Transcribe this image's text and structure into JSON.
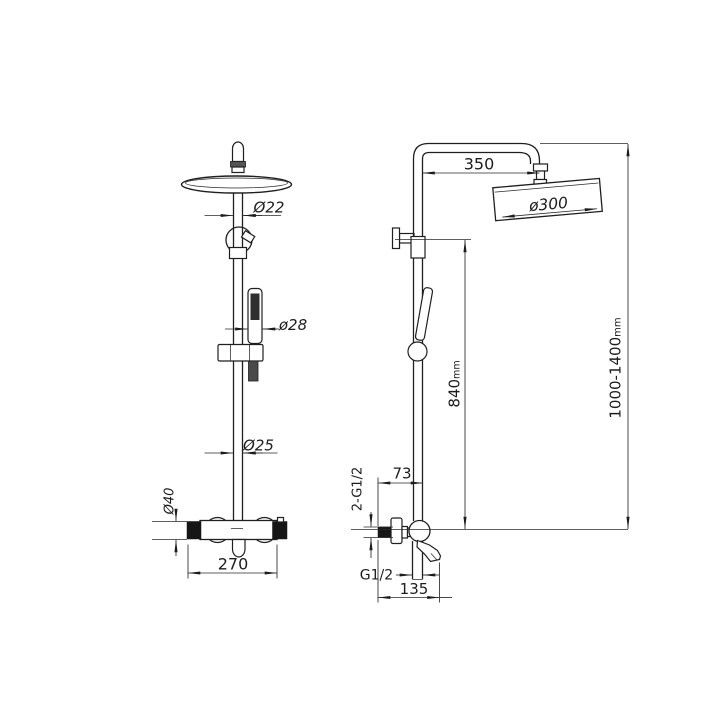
{
  "meta": {
    "background_color": "#ffffff",
    "line_color": "#1f1f1f",
    "drawing_type": "shower column technical dimension drawing",
    "views": {
      "left": "front view",
      "right": "side view"
    }
  },
  "front_view": {
    "labels": {
      "upper_pipe_d": "Ø22",
      "hand_shower_d": "ø28",
      "lower_pipe_d": "Ø25",
      "body_d": "Ø40",
      "body_width": "270"
    }
  },
  "side_view": {
    "labels": {
      "arm_projection": "350",
      "head_d": "ø300",
      "bracket_height": "840",
      "bracket_height_unit": "mm",
      "total_height": "1000-1400",
      "total_height_unit": "mm",
      "wall_offset": "73",
      "inlet_thread": "2-G1/2",
      "outlet_thread": "G1/2",
      "spout_reach": "135"
    }
  }
}
